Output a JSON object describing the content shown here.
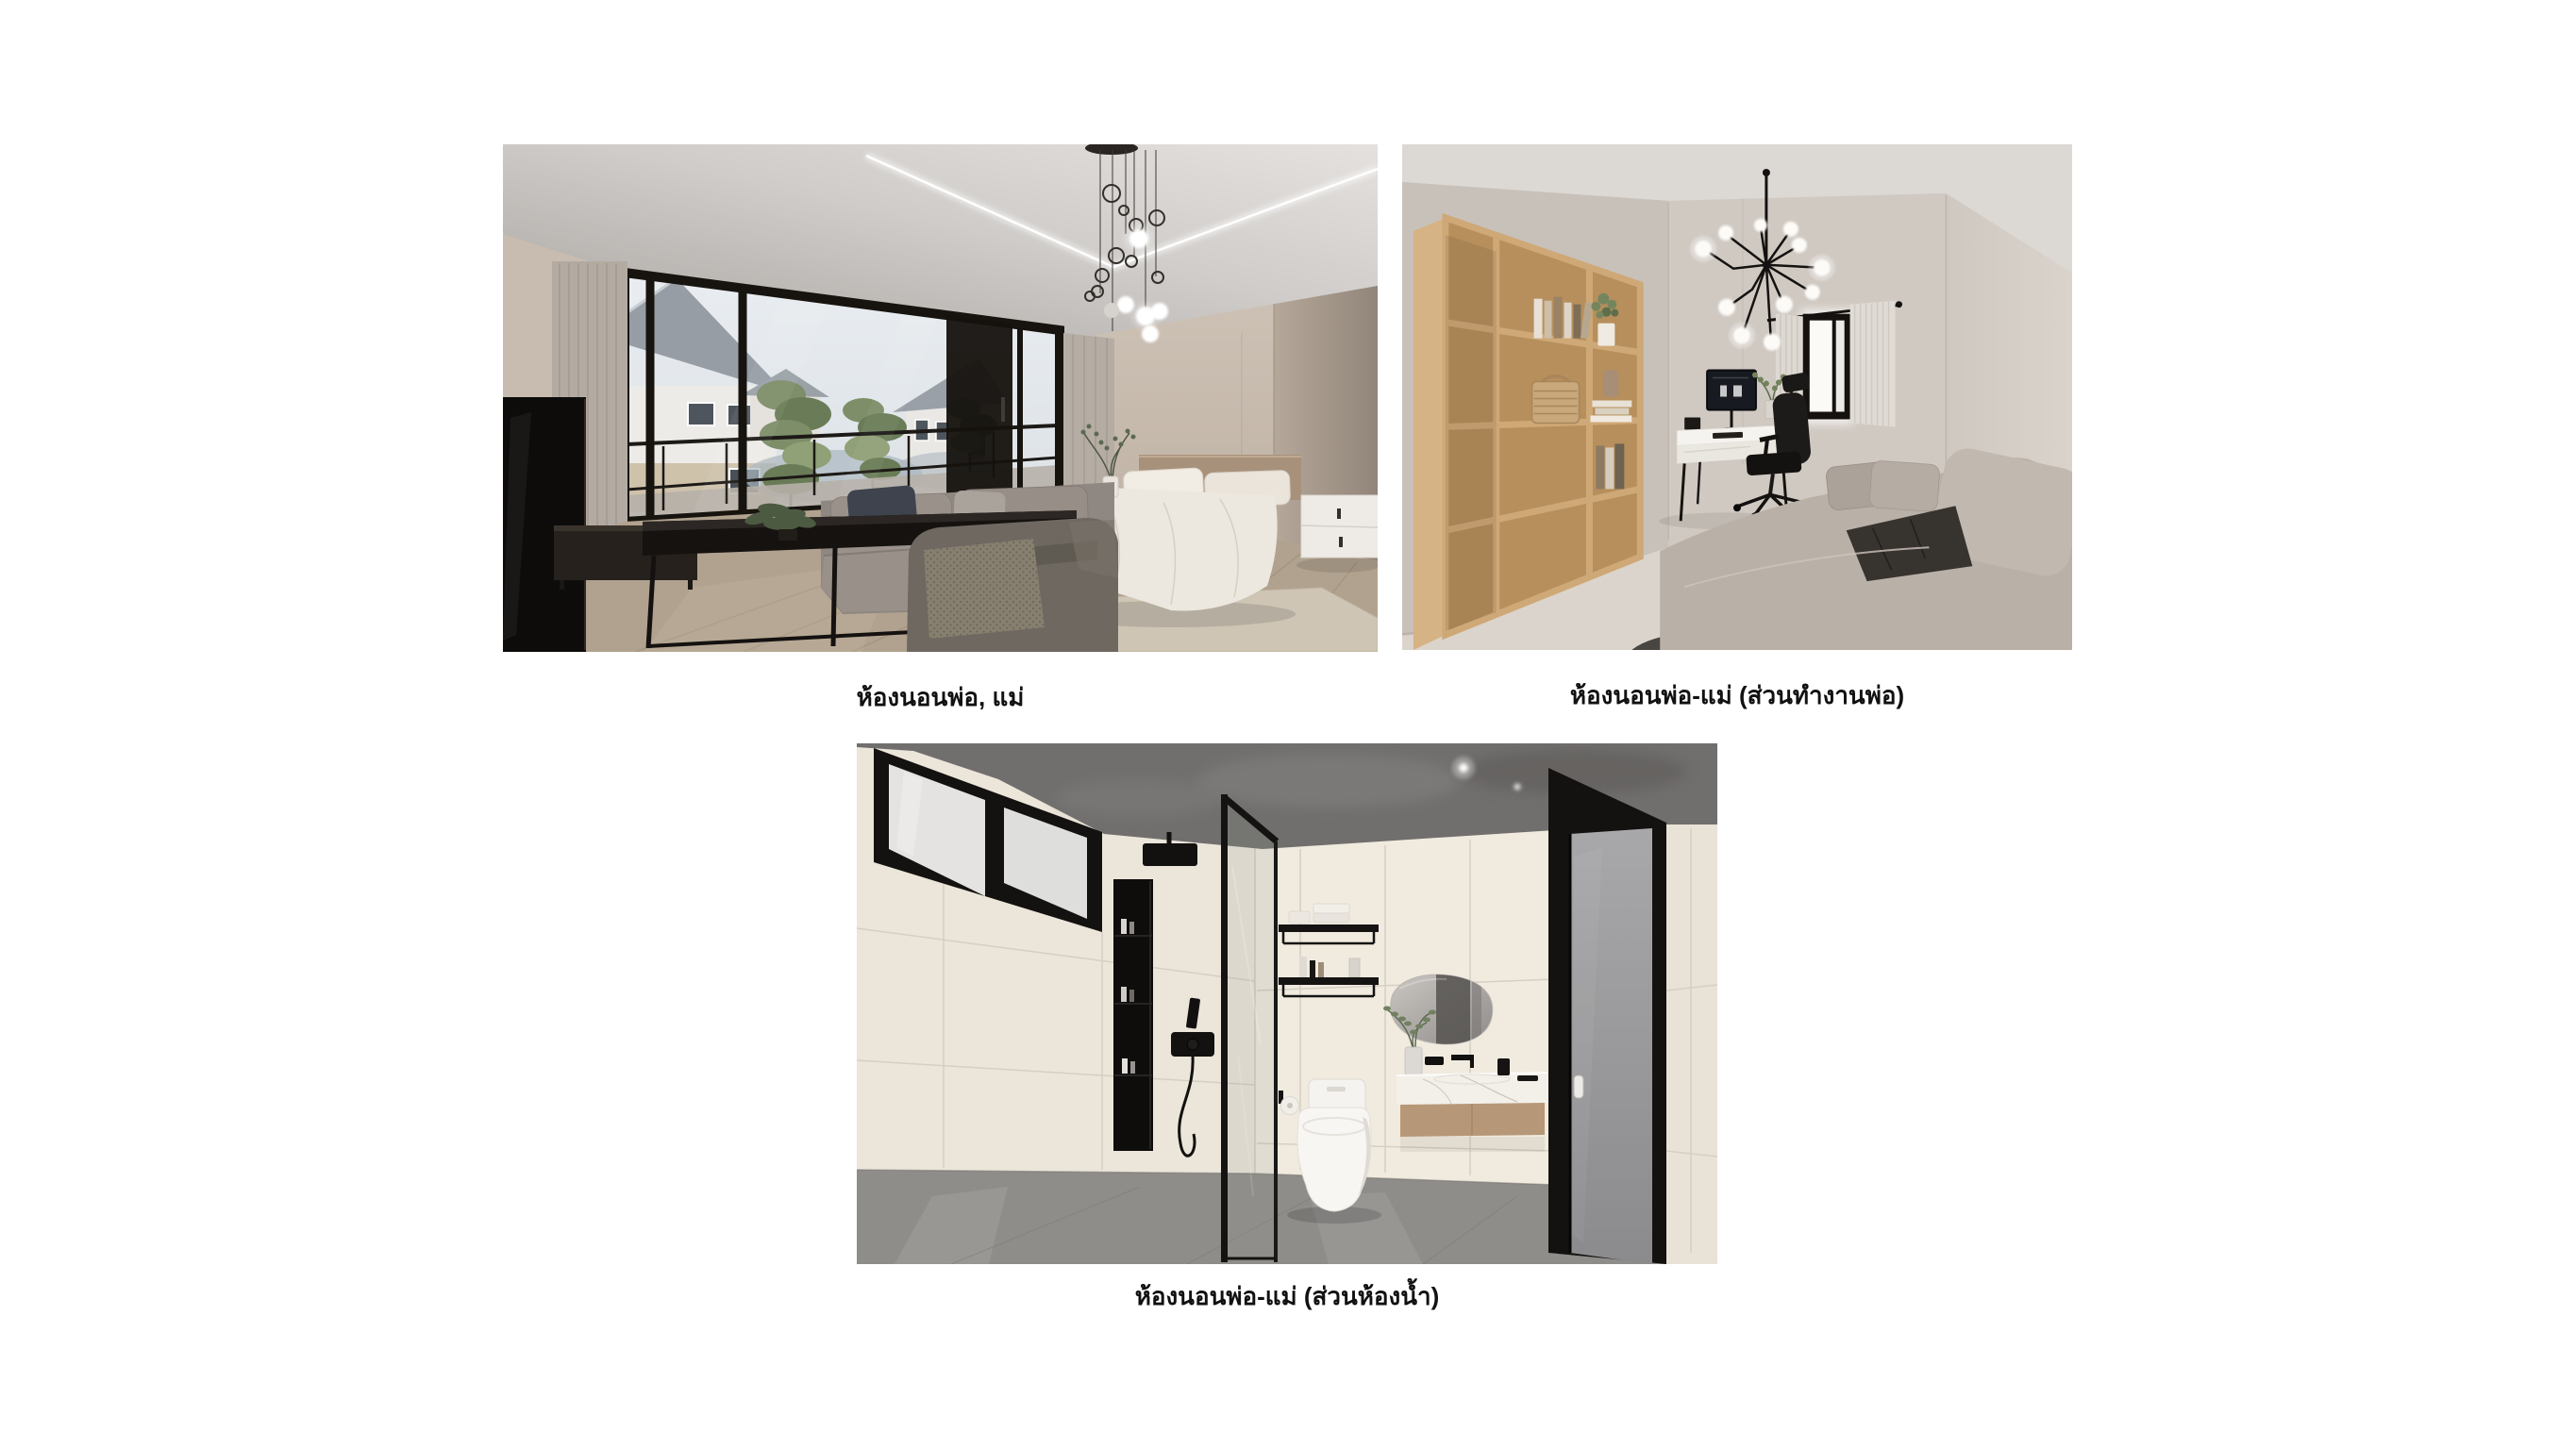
{
  "page": {
    "background": "#ffffff",
    "language": "th",
    "layout": "three labeled interior renders on a white sheet"
  },
  "figures": [
    {
      "name": "master-bedroom",
      "caption": "ห้องนอนพ่อ, แม่",
      "alt": "3D render of the parents' bedroom: gray sofa and armchair, black coffee table, TV, bed with white bedding, nightstand, floor-to-ceiling black-framed balcony windows with houses and trees outside, bubble pendant chandelier and LED cove ceiling"
    },
    {
      "name": "master-bedroom-father-work-area",
      "caption": "ห้องนอนพ่อ-แม่ (ส่วนทำงานพ่อ)",
      "alt": "3D render of the work corner in the parents' bedroom: tall oak open shelving with books and baskets, white desk with monitor, black office chair, black sputnik chandelier with white globes, window with sheer curtains and a light gray fabric sofa"
    },
    {
      "name": "master-bedroom-bathroom",
      "caption": "ห้องนอนพ่อ-แม่ (ส่วนห้องน้ำ)",
      "alt": "3D render of the parents' bathroom: cream tiled walls, concrete ceiling and gray floor, black framed frosted window, black rain shower and niche, glass partition, black wall shelves, organic-shaped mirror over a floating marble vanity, smart toilet and gray door with black frame"
    }
  ],
  "caption_style": {
    "color": "#111111"
  },
  "palette": {
    "page_background": "#ffffff",
    "caption_text": "#111111",
    "bedroom_wall": "#c8bcb0",
    "bedroom_ceiling": "#d8d4d1",
    "window_frame_black": "#17140f",
    "sofa_gray": "#8f8781",
    "bedding_white": "#ece7df",
    "oak_shelf": "#c49d6a",
    "office_chair_black": "#1b1917",
    "bathroom_tile": "#ece5da",
    "bathroom_ceiling_concrete": "#716f6d",
    "bathroom_floor": "#8f8d8a",
    "fixture_black": "#141210"
  }
}
